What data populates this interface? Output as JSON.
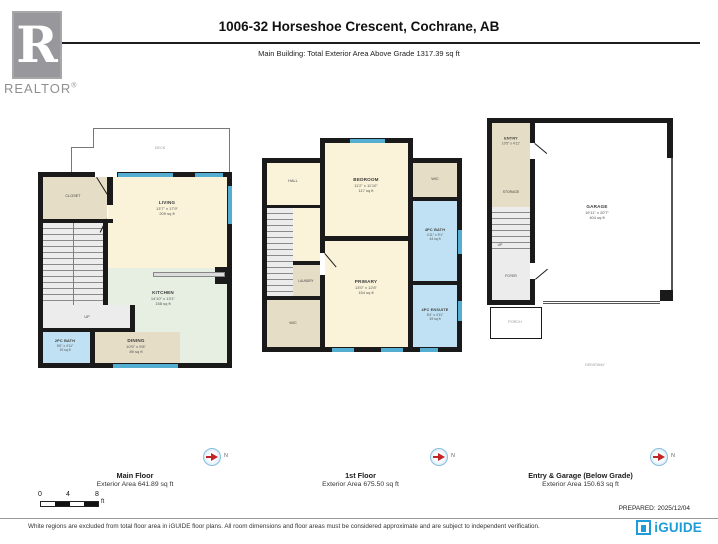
{
  "header": {
    "title": "1006-32 Horseshoe Crescent, Cochrane, AB",
    "subtitle": "Main Building: Total Exterior Area Above Grade 1317.39 sq ft",
    "logo_letter": "R",
    "logo_brand": "REALTOR",
    "logo_reg": "®"
  },
  "floors": {
    "main": {
      "name": "Main Floor",
      "area_text": "Exterior Area 641.89 sq ft",
      "rooms": {
        "deck": {
          "label": "DECK"
        },
        "closet": {
          "label": "CLOSET"
        },
        "living": {
          "label": "LIVING",
          "dims": "13'7\" x 17'9\"",
          "area": "209 sq ft"
        },
        "kitchen": {
          "label": "KITCHEN",
          "dims": "14'10\" x 13'1\"",
          "area": "158 sq ft"
        },
        "dining": {
          "label": "DINING",
          "dims": "10'5\" x 9'8\"",
          "area": "89 sq ft"
        },
        "bath": {
          "label": "2PC BATH",
          "dims": "5'6\" x 4'11\"",
          "area": "19 sq ft"
        },
        "up": "UP"
      }
    },
    "first": {
      "name": "1st Floor",
      "area_text": "Exterior Area 675.50 sq ft",
      "rooms": {
        "bedroom": {
          "label": "BEDROOM",
          "dims": "11'2\" x 11'10\"",
          "area": "117 sq ft"
        },
        "hall": {
          "label": "HALL"
        },
        "laundry": {
          "label": "LAUNDRY"
        },
        "wic_left": {
          "label": "WIC"
        },
        "wic_right": {
          "label": "WIC"
        },
        "primary": {
          "label": "PRIMARY",
          "dims": "13'0\" x 12'8\"",
          "area": "154 sq ft"
        },
        "bath": {
          "label": "4PC BATH",
          "dims": "4'11\" x 9'1\"",
          "area": "44 sq ft"
        },
        "ensuite": {
          "label": "4PC ENSUITE",
          "dims": "8'4\" x 4'11\"",
          "area": "39 sq ft"
        }
      }
    },
    "entry": {
      "name": "Entry & Garage (Below Grade)",
      "area_text": "Exterior Area 150.63 sq ft",
      "rooms": {
        "entry": {
          "label": "ENTRY",
          "dims": "10'5\" x 4'11\""
        },
        "storage": {
          "label": "STORAGE"
        },
        "up": "UP",
        "foyer": {
          "label": "FOYER"
        },
        "porch": {
          "label": "PORCH"
        },
        "garage": {
          "label": "GARAGE",
          "dims": "19'11\" x 20'7\"",
          "area": "404 sq ft"
        },
        "driveway": {
          "label": "DRIVEWAY"
        }
      }
    }
  },
  "compass": {
    "north_label": "N"
  },
  "scale_bar": {
    "ticks": [
      "0",
      "4",
      "8"
    ],
    "unit": "ft"
  },
  "footer": {
    "prepared": "PREPARED: 2025/12/04",
    "disclaimer": "White regions are excluded from total floor area in iGUIDE floor plans. All room dimensions and floor areas must be considered approximate and are subject to independent verification.",
    "brand": "iGUIDE"
  },
  "colors": {
    "wall": "#1a1a1a",
    "window": "#54aed2",
    "room_cream": "#faf3da",
    "room_green": "#e6efe1",
    "room_tan": "#e6ddc6",
    "room_blue": "#c0e1f3",
    "stairs_gray": "#ececec",
    "brand_blue": "#1e9cd7",
    "realtor_gray": "#98989c",
    "compass_needle": "#c22525"
  }
}
